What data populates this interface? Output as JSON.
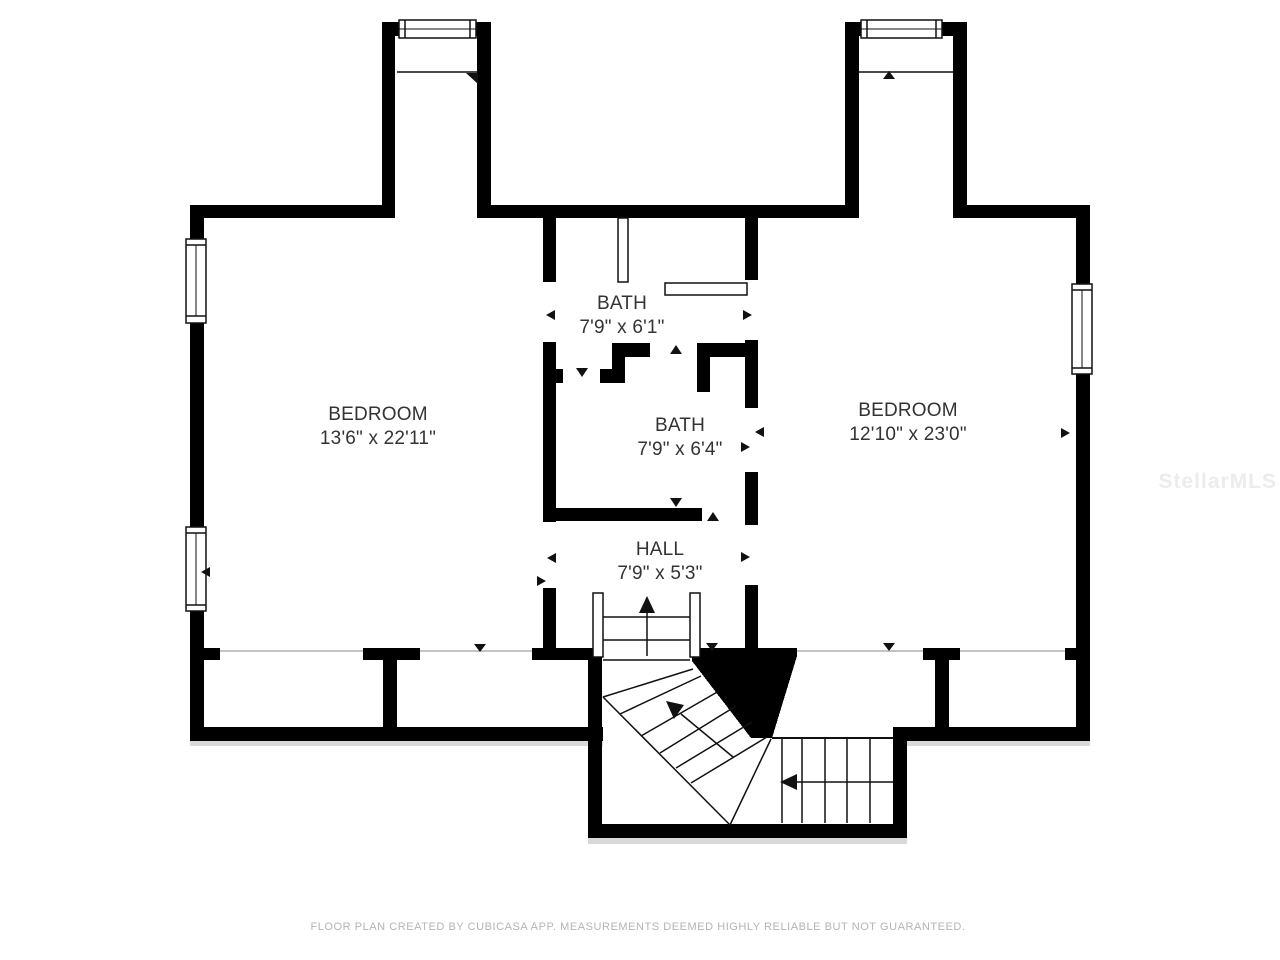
{
  "plan": {
    "rooms": [
      {
        "name": "BEDROOM",
        "dimensions": "13'6\" x 22'11\""
      },
      {
        "name": "BATH",
        "dimensions": "7'9\" x 6'1\""
      },
      {
        "name": "BATH",
        "dimensions": "7'9\" x 6'4\""
      },
      {
        "name": "HALL",
        "dimensions": "7'9\" x 5'3\""
      },
      {
        "name": "BEDROOM",
        "dimensions": "12'10\" x 23'0\""
      }
    ],
    "footer_disclaimer": "FLOOR PLAN CREATED BY CUBICASA APP. MEASUREMENTS DEEMED HIGHLY RELIABLE BUT NOT GUARANTEED.",
    "watermark": "StellarMLS",
    "colors": {
      "background": "#ffffff",
      "walls": "#000000",
      "room_labels": "#333333",
      "footer_text": "#b4b4b4",
      "watermark_text": "#ececec",
      "knee_wall_line": "#b0b0b0"
    }
  }
}
